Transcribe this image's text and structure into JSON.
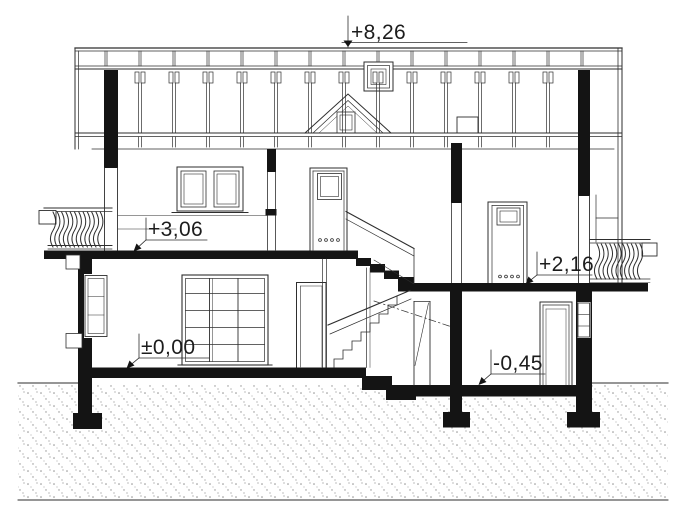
{
  "drawing": {
    "title": "House cross-section drawing",
    "type": "architectural-section",
    "levels": {
      "ridge": "+8,26",
      "upper_floor": "+3,06",
      "mezzanine": "+2,16",
      "ground_floor": "±0,00",
      "lower_ground": "-0,45"
    },
    "colors": {
      "line": "#2e2e2e",
      "fill_black": "#141414",
      "background": "#ffffff",
      "ground_dots": "#8f8f8f"
    }
  }
}
